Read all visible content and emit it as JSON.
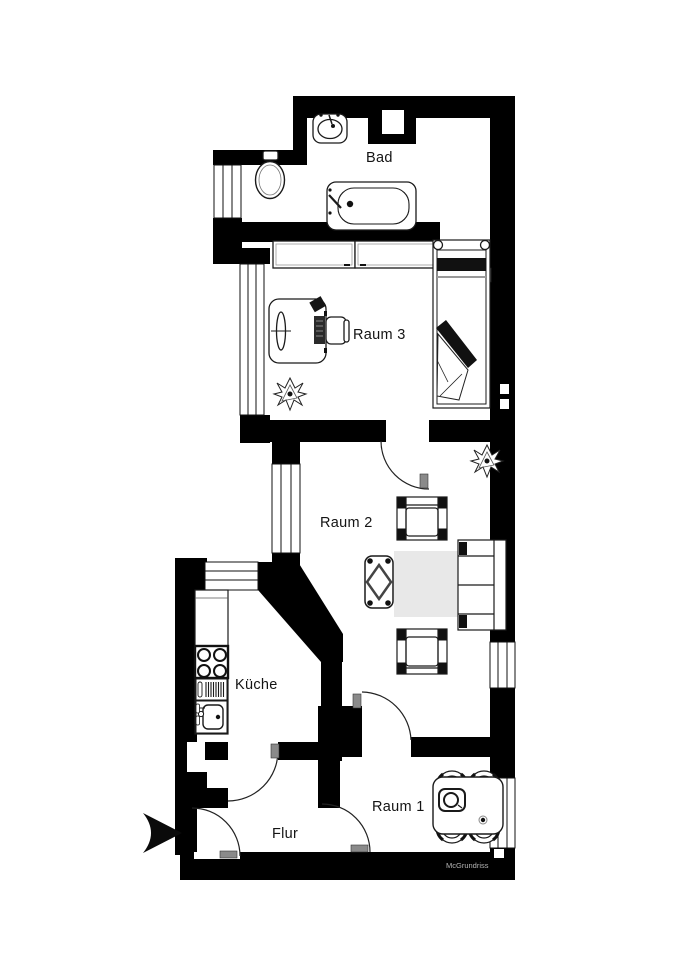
{
  "watermark": "McGrundriss",
  "rooms": [
    {
      "id": "bad",
      "label": "Bad",
      "fixtures": [
        "sink",
        "toilet",
        "bathtub",
        "window"
      ]
    },
    {
      "id": "raum3",
      "label": "Raum 3",
      "fixtures": [
        "wardrobe",
        "desk",
        "desk-chair",
        "plant",
        "bed",
        "window"
      ]
    },
    {
      "id": "raum2",
      "label": "Raum 2",
      "fixtures": [
        "plant",
        "armchair",
        "coffee-table",
        "rug",
        "sofa",
        "armchair",
        "window"
      ]
    },
    {
      "id": "kueche",
      "label": "Küche",
      "fixtures": [
        "counter",
        "stove",
        "dishwasher",
        "kitchen-sink",
        "window"
      ]
    },
    {
      "id": "flur",
      "label": "Flur",
      "fixtures": [
        "entrance-arrow",
        "entrance-door"
      ]
    },
    {
      "id": "raum1",
      "label": "Raum 1",
      "fixtures": [
        "dining-table",
        "chair",
        "chair",
        "chair",
        "chair",
        "window"
      ]
    }
  ],
  "colors": {
    "wall": "#000000",
    "floor": "#ffffff",
    "rug": "#e8e8e8",
    "door_leaf": "#8a8a8a",
    "label_text": "#141414",
    "watermark_text": "#b5b5b5"
  }
}
